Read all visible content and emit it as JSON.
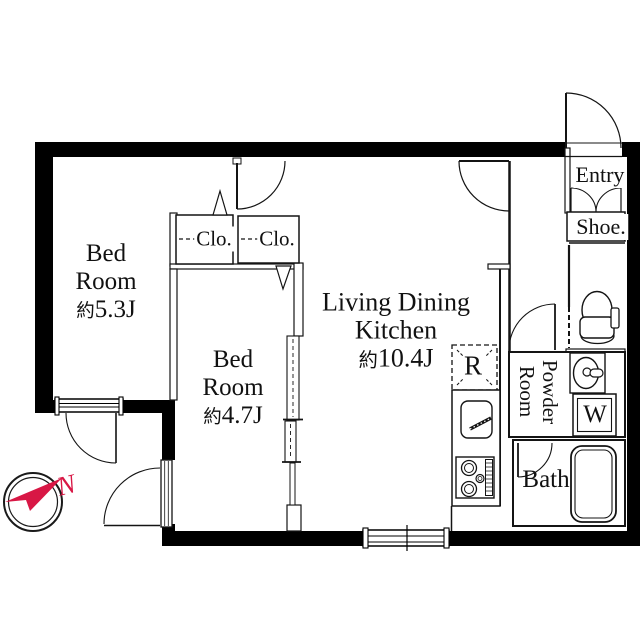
{
  "rooms": {
    "bedroom1": {
      "line1": "Bed",
      "line2": "Room",
      "area_prefix": "約",
      "area_value": "5.3J"
    },
    "bedroom2": {
      "line1": "Bed",
      "line2": "Room",
      "area_prefix": "約",
      "area_value": "4.7J"
    },
    "ldk": {
      "line1": "Living Dining",
      "line2": "Kitchen",
      "area_prefix": "約",
      "area_value": "10.4J"
    },
    "closet_left": {
      "label": "Clo."
    },
    "closet_right": {
      "label": "Clo."
    },
    "entry": {
      "label": "Entry"
    },
    "shoe": {
      "label": "Shoe."
    },
    "powder_room": {
      "line1": "Powder",
      "line2": "Room"
    },
    "bath": {
      "label": "Bath"
    }
  },
  "fixtures": {
    "refrigerator_label": "R",
    "washer_label": "W"
  },
  "compass": {
    "label": "N",
    "color": "#d81745"
  },
  "colors": {
    "wall": "#000000",
    "line": "#141414"
  }
}
